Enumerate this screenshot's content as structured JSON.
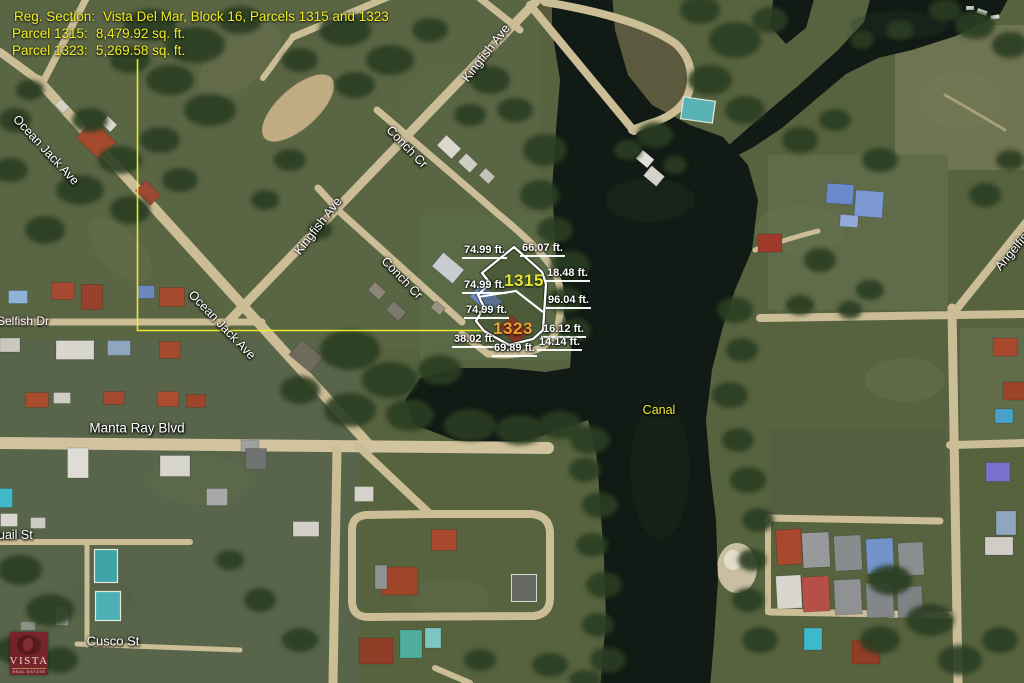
{
  "callout": {
    "reg_section_label": "Reg. Section:",
    "reg_section_value": "Vista Del Mar, Block 16, Parcels 1315 and 1323",
    "parcel_1315_label": "Parcel 1315:",
    "parcel_1315_value": "8,479.92 sq. ft.",
    "parcel_1323_label": "Parcel 1323:",
    "parcel_1323_value": "5,269.58 sq. ft."
  },
  "parcels": [
    {
      "id": "1315",
      "area": "8,479.92 sq. ft.",
      "label_color": "#e3e532"
    },
    {
      "id": "1323",
      "area": "5,269.58 sq. ft.",
      "label_color": "#f0a02a"
    }
  ],
  "measurements": [
    "74.99 ft.",
    "66.07 ft.",
    "18.48 ft.",
    "74.99 ft.",
    "96.04 ft.",
    "74.99 ft.",
    "16.12 ft.",
    "14.14 ft.",
    "38.02 ft.",
    "69.89 ft."
  ],
  "streets": {
    "kingfish_upper": "Kingfish Ave",
    "kingfish_lower": "Kingfish Ave",
    "conch_upper": "Conch Cr",
    "conch_lower": "Conch Cr",
    "ocean_jack_upper": "Ocean Jack Ave",
    "ocean_jack_lower": "Ocean Jack Ave",
    "selfish": "Selfish Dr",
    "manta_ray": "Manta Ray Blvd",
    "quail": "uail St",
    "cusco": "Cusco St",
    "canal": "Canal",
    "angelfish": "Angelfish"
  },
  "logo": {
    "name": "VISTA",
    "subtitle": "REAL ESTATE"
  },
  "colors": {
    "annotation_yellow": "#f2ef25",
    "callout_line": "#f2ef2a",
    "parcel_outline": "#ffffff",
    "parcel_1315_label": "#e3e532",
    "parcel_1323_label": "#f0a02a",
    "street_label": "#ffffff",
    "water": "#111a14",
    "road": "#cbbd96",
    "logo_bg": "#7b2027"
  }
}
